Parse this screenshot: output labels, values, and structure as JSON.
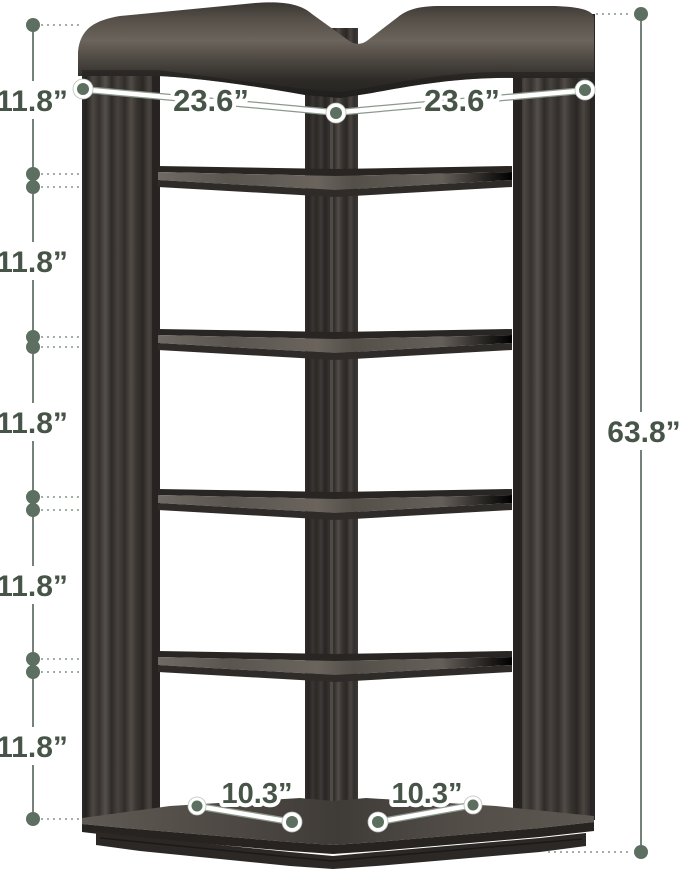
{
  "diagram": {
    "type": "furniture-dimension-diagram",
    "subject": "6-tier corner bookshelf",
    "labels": {
      "tier_heights": [
        "11.8”",
        "11.8”",
        "11.8”",
        "11.8”",
        "11.8”"
      ],
      "top_widths": [
        "23.6”",
        "23.6”"
      ],
      "total_height": "63.8”",
      "base_depths": [
        "10.3”",
        "10.3”"
      ]
    },
    "colors": {
      "dimension_text": "#475548",
      "dimension_line": "#75827a",
      "dot_fill": "#5d6f60",
      "leader_dotted": "#a3afa4",
      "wood_dark": "#2c2927",
      "wood_mid": "#46413d",
      "wood_light": "#6b645c",
      "background": "#ffffff"
    }
  }
}
